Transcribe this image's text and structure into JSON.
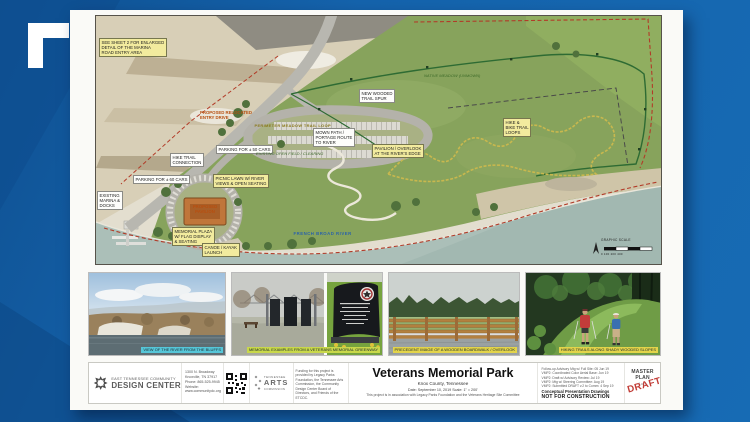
{
  "scene": {
    "bg_color": "#1563ac",
    "accent_dark": "#0e4f90"
  },
  "map": {
    "labels": [
      {
        "text": "SEE SHEET 2 FOR ENLARGED\nDETAIL OF THE MARINA\nROAD ENTRY AREA"
      },
      {
        "text": "PROPOSED RELOCATED\nENTRY DRIVE"
      },
      {
        "text": "HIKE TRAIL\nCONNECTION"
      },
      {
        "text": "PARKING FOR ± 50 CARS"
      },
      {
        "text": "EXISTING OPEN FIELD / CLEARING"
      },
      {
        "text": "MOWN PATH /\nPORTAGE ROUTE\nTO RIVER"
      },
      {
        "text": "PAVILION / OVERLOOK\nAT THE RIVER'S EDGE"
      },
      {
        "text": "PICNIC LAWN W/ RIVER\nVIEWS & OPEN SEATING"
      },
      {
        "text": "HIKE &\nBIKE TRAIL\nLOOPS"
      },
      {
        "text": "NEW WOODED\nTRAIL SPUR"
      },
      {
        "text": "PERIMETER MEADOW TRAIL LOOP"
      },
      {
        "text": "EXISTING\nMARINA &\nDOCKS"
      },
      {
        "text": "PARKING FOR ± 60 CARS"
      },
      {
        "text": "PROPOSED\nPAVILION"
      },
      {
        "text": "MEMORIAL PLAZA\nW/ FLAG DISPLAY\n& SEATING"
      },
      {
        "text": "CANOE / KAYAK\nLAUNCH"
      },
      {
        "text": "FRENCH BROAD RIVER"
      },
      {
        "text": "NATIVE MEADOW (UNMOWN)"
      }
    ],
    "graphic_scale_label": "GRAPHIC SCALE",
    "scale_numbers": "0    100   200         400"
  },
  "photos": [
    {
      "caption": "VIEW OF THE RIVER FROM THE BLUFFS"
    },
    {
      "caption": "MEMORIAL EXAMPLES FROM A VETERANS MEMORIAL GREENWAY"
    },
    {
      "caption": "PRECEDENT IMAGE OF A WOODEN BOARDWALK / OVERLOOK"
    },
    {
      "caption": "HIKING TRAILS ALONG SHADY WOODED SLOPES"
    }
  ],
  "titleblock": {
    "org_line1": "EAST TENNESSEE COMMUNITY",
    "org_line2": "DESIGN CENTER",
    "address": "1300 N. Broadway\nKnoxville, TN 37917\nPhone: 865-525-9945\nWebsite: www.communitydc.org",
    "arts_line1": "TENNESSEE",
    "arts_line2": "ARTS",
    "arts_line3": "COMMISSION",
    "funding": "Funding for this project is provided by Legacy Parks Foundation, the Tennessee Arts Commission, the Community Design Center Board of Directors, and Friends of the ETCDC.",
    "title": "Veterans Memorial Park",
    "subtitle": "Knox County, Tennessee",
    "date_scale": "Date: September 10, 2019        Scale: 1\" = 200'",
    "association": "This project is in association with Legacy Parks Foundation and the Veterans Heritage Site Committee",
    "revisions": "Follow-up Advisory Mtg w/ Full Site: 05 Jun 19\nVMP2: Coordinated Color Aerial Base: Jun 19\nVMP2: Draft w/ Advisory Review: Jul 19\nVMP2: Mtg w/ Steering Committee: Aug 19\nVMP2: Submitted DRAFT v.2 to Comm: 4 Sep 19",
    "conceptual": "Conceptual Presentation Drawings",
    "not_for_construction": "NOT FOR CONSTRUCTION",
    "master_plan": "MASTER PLAN",
    "sheet": "1  of  1",
    "draft": "DRAFT"
  }
}
